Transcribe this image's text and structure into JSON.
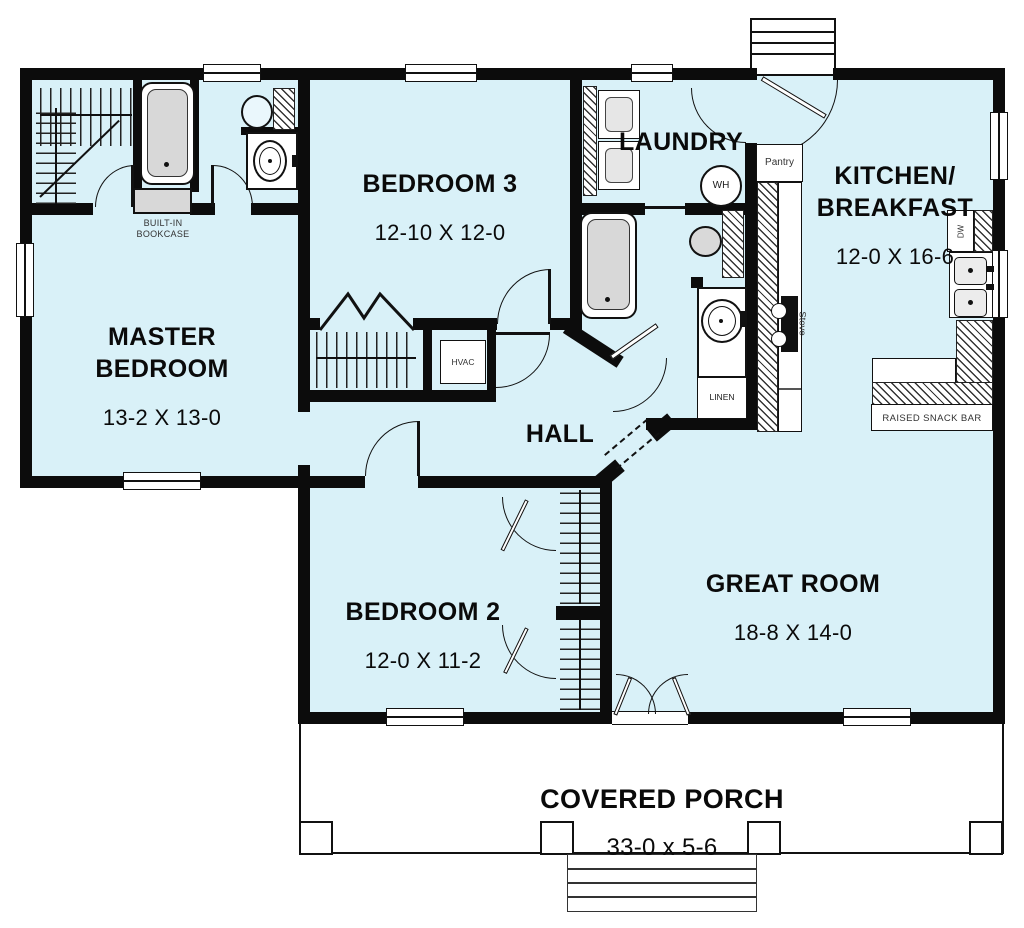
{
  "colors": {
    "floor": "#d9f1f8",
    "wall": "#0c0c0c",
    "paper": "#ffffff"
  },
  "rooms": {
    "master_bedroom": {
      "label": "MASTER\nBEDROOM",
      "dims": "13-2 X 13-0"
    },
    "bedroom3": {
      "label": "BEDROOM 3",
      "dims": "12-10 X 12-0"
    },
    "laundry": {
      "label": "LAUNDRY"
    },
    "kitchen_breakfast": {
      "label": "KITCHEN/\nBREAKFAST",
      "dims": "12-0 X 16-6"
    },
    "hall": {
      "label": "HALL"
    },
    "bedroom2": {
      "label": "BEDROOM 2",
      "dims": "12-0 X 11-2"
    },
    "great_room": {
      "label": "GREAT ROOM",
      "dims": "18-8 X 14-0"
    },
    "covered_porch": {
      "label": "COVERED PORCH",
      "dims": "33-0 x 5-6"
    }
  },
  "features": {
    "bookcase": "BUILT-IN\nBOOKCASE",
    "hvac": "HVAC",
    "linen": "LINEN",
    "pantry": "Pantry",
    "stove": "Stove",
    "water_heater": "WH",
    "dishwasher": "DW",
    "snack_bar": "RAISED SNACK BAR"
  }
}
